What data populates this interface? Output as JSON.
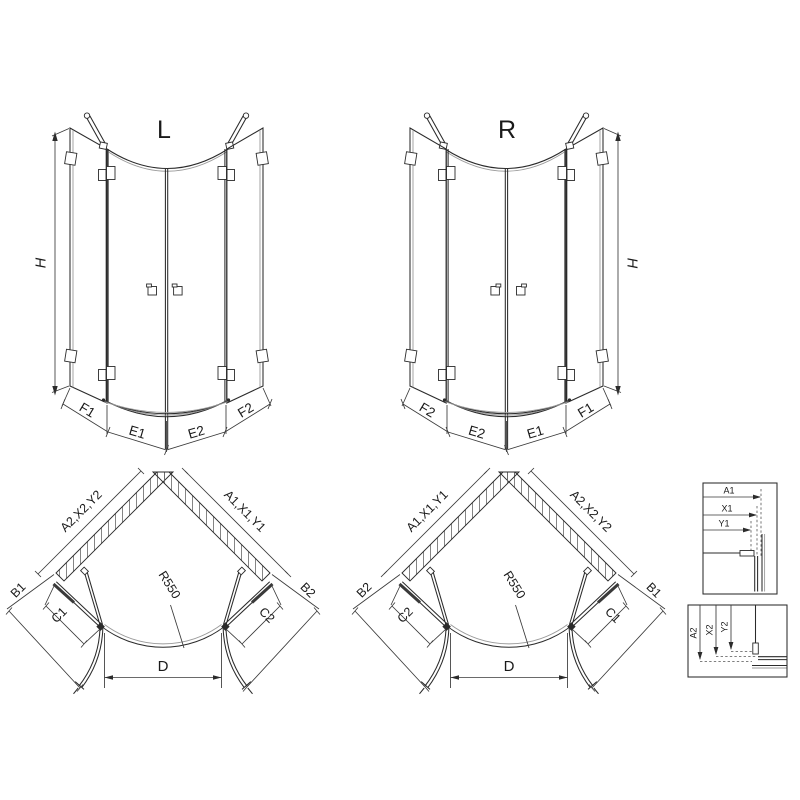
{
  "colors": {
    "line": "#2b2b2b",
    "light": "#9a9a9a",
    "background": "#ffffff"
  },
  "elevation_left": {
    "title": "L",
    "height": "H",
    "seg1": "F1",
    "seg2": "E1",
    "seg3": "E2",
    "seg4": "F2"
  },
  "elevation_right": {
    "title": "R",
    "height": "H",
    "seg1": "F2",
    "seg2": "E2",
    "seg3": "E1",
    "seg4": "F1"
  },
  "plan_left": {
    "wall_left": "A2,X2,Y2",
    "wall_right": "A1,X1,Y1",
    "side_left": "B1",
    "side_right": "B2",
    "fixed_left": "C1",
    "fixed_right": "C2",
    "radius": "R550",
    "opening": "D"
  },
  "plan_right": {
    "wall_left": "A1,X1,Y1",
    "wall_right": "A2,X2,Y2",
    "side_left": "B2",
    "side_right": "B1",
    "fixed_left": "C2",
    "fixed_right": "C1",
    "radius": "R550",
    "opening": "D"
  },
  "detail_top": {
    "dim1": "A1",
    "dim2": "X1",
    "dim3": "Y1"
  },
  "detail_bottom": {
    "dim1": "A2",
    "dim2": "X2",
    "dim3": "Y2"
  }
}
